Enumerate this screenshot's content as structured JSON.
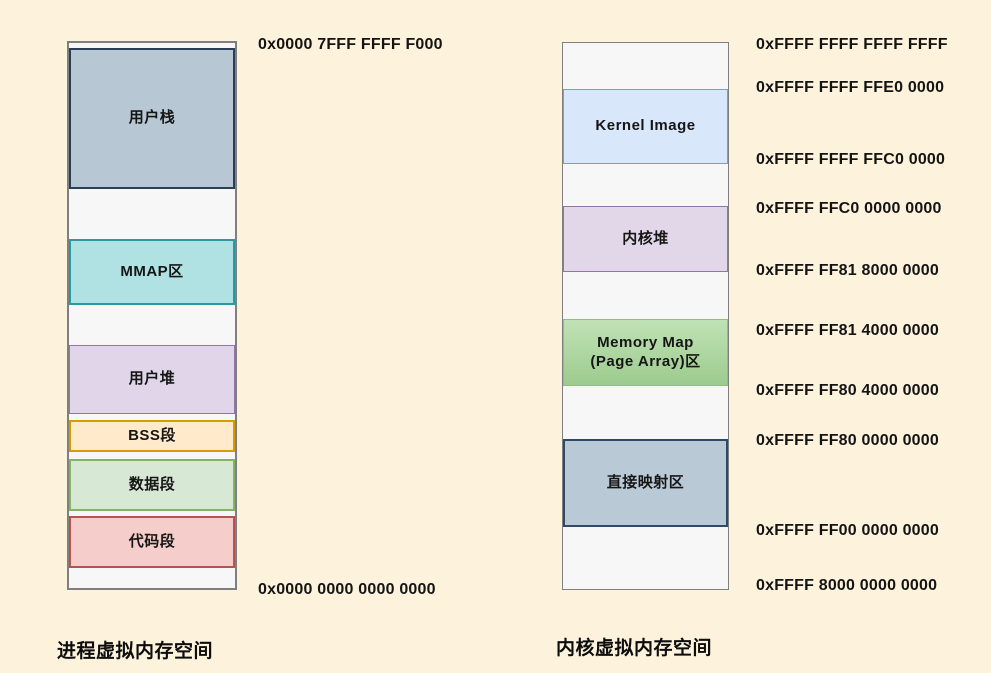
{
  "page": {
    "background_color": "#fdf3dd",
    "column_fill": "#f7f7f7",
    "column_border": "#7f7f7f"
  },
  "left_diagram": {
    "title": "进程虚拟内存空间",
    "top_address": "0x0000 7FFF FFFF F000",
    "bottom_address": "0x0000 0000 0000 0000",
    "segments": {
      "user_stack": {
        "label": "用户栈",
        "fill": "#b7c7d3",
        "border": "#2a3f55"
      },
      "mmap": {
        "label": "MMAP区",
        "fill": "#b0e2e4",
        "border": "#2b9aa0"
      },
      "user_heap": {
        "label": "用户堆",
        "fill": "#e0d5e9",
        "border": "#9673a6"
      },
      "bss": {
        "label": "BSS段",
        "fill": "#ffeacb",
        "border": "#d79b00"
      },
      "data_seg": {
        "label": "数据段",
        "fill": "#d7e9d4",
        "border": "#82b366"
      },
      "code_seg": {
        "label": "代码段",
        "fill": "#f5cecb",
        "border": "#b85450"
      }
    }
  },
  "right_diagram": {
    "title": "内核虚拟内存空间",
    "segments": {
      "kernel_image": {
        "label": "Kernel Image",
        "fill": "#d9e7fb",
        "border": "#7e9cc9"
      },
      "kernel_heap": {
        "label": "内核堆",
        "fill": "#e2d6e9",
        "border": "#9673a6"
      },
      "memory_map": {
        "label": "Memory Map\n(Page Array)区",
        "fill": "#a5d696",
        "border": "#8fbf79"
      },
      "direct_map": {
        "label": "直接映射区",
        "fill": "#b9c9d5",
        "border": "#2e4a66"
      }
    },
    "addresses": {
      "a0": "0xFFFF FFFF FFFF FFFF",
      "a1": "0xFFFF FFFF FFE0 0000",
      "a2": "0xFFFF FFFF FFC0 0000",
      "a3": "0xFFFF FFC0 0000 0000",
      "a4": "0xFFFF FF81 8000 0000",
      "a5": "0xFFFF FF81 4000 0000",
      "a6": "0xFFFF FF80 4000 0000",
      "a7": "0xFFFF FF80 0000 0000",
      "a8": "0xFFFF FF00 0000 0000",
      "a9": "0xFFFF 8000 0000 0000"
    }
  }
}
